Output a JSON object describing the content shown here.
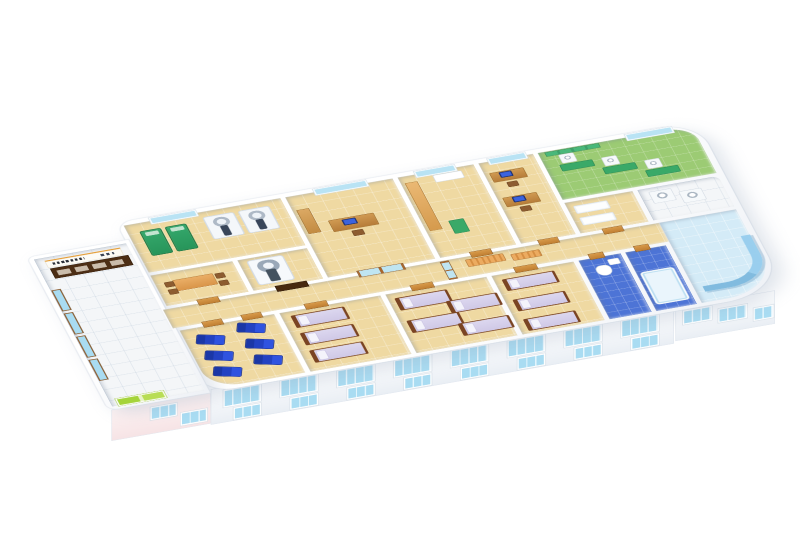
{
  "figure": {
    "type": "3d-isometric-floor-plan",
    "subject": "clinic-ward-floor",
    "background": "#ffffff"
  },
  "palette": {
    "wall": "#ffffff",
    "floor_tile": "#efd9a2",
    "lobby_tile": "#f4f6f8",
    "bath_blue": "#4d74d6",
    "physio_green": "#9ccb74",
    "lounge_blue": "#d4ebf7",
    "window_blue": "#a9dcf2",
    "door_wood": "#c98636",
    "bed_linen": "#d5d0e9",
    "bed_frame": "#7a4423",
    "recliner_blue": "#2342c2",
    "exam_green": "#2f9e62",
    "reception_brown": "#4c2e15",
    "sign_accent": "#e59f3a",
    "entrance_green": "#a5d43a"
  },
  "scene": {
    "plan": {
      "w": 1080,
      "h": 520
    },
    "slabs": [
      {
        "id": "main-wing",
        "x": 160,
        "y": 8,
        "w": 918,
        "h": 470,
        "br": "26px 64px 96px 44px"
      },
      {
        "id": "lobby-wing",
        "x": 4,
        "y": 56,
        "w": 160,
        "h": 422,
        "br": "12px 0px 0px 16px"
      }
    ],
    "rooms": [
      {
        "id": "lobby",
        "x": 12,
        "y": 64,
        "w": 146,
        "h": 406,
        "floor": "white",
        "br": "0"
      },
      {
        "id": "radiology",
        "x": 168,
        "y": 18,
        "w": 248,
        "h": 130,
        "floor": "beige",
        "br": "0"
      },
      {
        "id": "meeting",
        "x": 168,
        "y": 156,
        "w": 130,
        "h": 84,
        "floor": "beige",
        "br": "0"
      },
      {
        "id": "ct",
        "x": 306,
        "y": 156,
        "w": 110,
        "h": 84,
        "floor": "beige",
        "br": "0"
      },
      {
        "id": "consult-office",
        "x": 424,
        "y": 18,
        "w": 170,
        "h": 222,
        "floor": "beige",
        "br": "0"
      },
      {
        "id": "prep",
        "x": 602,
        "y": 18,
        "w": 120,
        "h": 222,
        "floor": "beige",
        "br": "0"
      },
      {
        "id": "doctor-office",
        "x": 730,
        "y": 18,
        "w": 86,
        "h": 222,
        "floor": "beige",
        "br": "0"
      },
      {
        "id": "physio",
        "x": 824,
        "y": 18,
        "w": 244,
        "h": 130,
        "floor": "green",
        "br": "0 40px 0 0"
      },
      {
        "id": "exam",
        "x": 824,
        "y": 156,
        "w": 108,
        "h": 84,
        "floor": "beige",
        "br": "0"
      },
      {
        "id": "utility",
        "x": 940,
        "y": 156,
        "w": 128,
        "h": 84,
        "floor": "white",
        "br": "0 12px 0 0"
      },
      {
        "id": "corridor",
        "x": 160,
        "y": 248,
        "w": 786,
        "h": 52,
        "floor": "beige",
        "br": "0"
      },
      {
        "id": "recliner-room",
        "x": 168,
        "y": 308,
        "w": 150,
        "h": 162,
        "floor": "beige",
        "br": "0 0 0 52px"
      },
      {
        "id": "ward-1",
        "x": 326,
        "y": 308,
        "w": 160,
        "h": 162,
        "floor": "beige",
        "br": "0"
      },
      {
        "id": "ward-2",
        "x": 494,
        "y": 308,
        "w": 160,
        "h": 162,
        "floor": "beige",
        "br": "0"
      },
      {
        "id": "ward-3",
        "x": 662,
        "y": 308,
        "w": 130,
        "h": 162,
        "floor": "beige",
        "br": "0"
      },
      {
        "id": "bathroom-1",
        "x": 800,
        "y": 308,
        "w": 66,
        "h": 162,
        "floor": "blue",
        "br": "0"
      },
      {
        "id": "bathroom-2",
        "x": 874,
        "y": 308,
        "w": 64,
        "h": 162,
        "floor": "blue",
        "br": "0"
      },
      {
        "id": "lounge",
        "x": 946,
        "y": 248,
        "w": 122,
        "h": 222,
        "floor": "lounge",
        "br": "0 0 84px 0"
      }
    ],
    "items": [
      {
        "t": "sign",
        "x": 26,
        "y": 72,
        "w": 118,
        "h": 16
      },
      {
        "t": "reception",
        "x": 28,
        "y": 94,
        "w": 122,
        "h": 26
      },
      {
        "t": "windowb",
        "x": 13,
        "y": 150,
        "w": 11,
        "h": 54
      },
      {
        "t": "windowb",
        "x": 13,
        "y": 214,
        "w": 11,
        "h": 54
      },
      {
        "t": "windowb",
        "x": 13,
        "y": 278,
        "w": 11,
        "h": 54
      },
      {
        "t": "windowb",
        "x": 13,
        "y": 342,
        "w": 11,
        "h": 54
      },
      {
        "t": "greendoor",
        "x": 22,
        "y": 452,
        "w": 72,
        "h": 16
      },
      {
        "t": "window",
        "x": 210,
        "y": 10,
        "w": 70,
        "h": 13
      },
      {
        "t": "greenbed",
        "x": 186,
        "y": 40,
        "w": 30,
        "h": 64
      },
      {
        "t": "greenbed",
        "x": 226,
        "y": 40,
        "w": 30,
        "h": 64
      },
      {
        "t": "scanner",
        "x": 288,
        "y": 32,
        "w": 46,
        "h": 58
      },
      {
        "t": "scanner",
        "x": 344,
        "y": 32,
        "w": 46,
        "h": 58
      },
      {
        "t": "table",
        "x": 196,
        "y": 178,
        "w": 62,
        "h": 28
      },
      {
        "t": "chair",
        "x": 182,
        "y": 180,
        "w": 13,
        "h": 12
      },
      {
        "t": "chair",
        "x": 182,
        "y": 200,
        "w": 13,
        "h": 12
      },
      {
        "t": "chair",
        "x": 262,
        "y": 180,
        "w": 13,
        "h": 12
      },
      {
        "t": "chair",
        "x": 262,
        "y": 200,
        "w": 13,
        "h": 12
      },
      {
        "t": "ct",
        "x": 318,
        "y": 162,
        "w": 54,
        "h": 64
      },
      {
        "t": "doordark",
        "x": 340,
        "y": 238,
        "w": 48,
        "h": 14
      },
      {
        "t": "door",
        "x": 216,
        "y": 238,
        "w": 32,
        "h": 14
      },
      {
        "t": "window",
        "x": 470,
        "y": 10,
        "w": 80,
        "h": 13
      },
      {
        "t": "cab",
        "x": 430,
        "y": 56,
        "w": 18,
        "h": 64
      },
      {
        "t": "desk",
        "x": 468,
        "y": 96,
        "w": 70,
        "h": 30
      },
      {
        "t": "monitor",
        "x": 488,
        "y": 100,
        "w": 18,
        "h": 12
      },
      {
        "t": "chair",
        "x": 494,
        "y": 132,
        "w": 16,
        "h": 13
      },
      {
        "t": "glassdoor",
        "x": 470,
        "y": 236,
        "w": 72,
        "h": 16
      },
      {
        "t": "window",
        "x": 630,
        "y": 10,
        "w": 60,
        "h": 13
      },
      {
        "t": "counter",
        "x": 608,
        "y": 36,
        "w": 18,
        "h": 130
      },
      {
        "t": "sink",
        "x": 654,
        "y": 28,
        "w": 44,
        "h": 18
      },
      {
        "t": "mat",
        "x": 642,
        "y": 150,
        "w": 22,
        "h": 34
      },
      {
        "t": "door",
        "x": 648,
        "y": 238,
        "w": 32,
        "h": 14
      },
      {
        "t": "window",
        "x": 746,
        "y": 10,
        "w": 56,
        "h": 13
      },
      {
        "t": "desk",
        "x": 738,
        "y": 48,
        "w": 52,
        "h": 24
      },
      {
        "t": "monitor",
        "x": 752,
        "y": 50,
        "w": 16,
        "h": 11
      },
      {
        "t": "chair",
        "x": 756,
        "y": 78,
        "w": 15,
        "h": 12
      },
      {
        "t": "desk",
        "x": 738,
        "y": 116,
        "w": 52,
        "h": 24
      },
      {
        "t": "monitor",
        "x": 752,
        "y": 118,
        "w": 16,
        "h": 11
      },
      {
        "t": "chair",
        "x": 756,
        "y": 146,
        "w": 15,
        "h": 12
      },
      {
        "t": "door",
        "x": 756,
        "y": 238,
        "w": 30,
        "h": 14
      },
      {
        "t": "greenwall",
        "x": 834,
        "y": 20,
        "w": 84,
        "h": 10
      },
      {
        "t": "window",
        "x": 964,
        "y": 10,
        "w": 70,
        "h": 13
      },
      {
        "t": "machine",
        "x": 852,
        "y": 32,
        "w": 22,
        "h": 22
      },
      {
        "t": "mat",
        "x": 846,
        "y": 58,
        "w": 50,
        "h": 16
      },
      {
        "t": "machine",
        "x": 912,
        "y": 58,
        "w": 22,
        "h": 22
      },
      {
        "t": "mat",
        "x": 906,
        "y": 84,
        "w": 50,
        "h": 16
      },
      {
        "t": "machine",
        "x": 972,
        "y": 84,
        "w": 22,
        "h": 22
      },
      {
        "t": "mat",
        "x": 966,
        "y": 110,
        "w": 50,
        "h": 16
      },
      {
        "t": "extable",
        "x": 834,
        "y": 168,
        "w": 52,
        "h": 20
      },
      {
        "t": "extable",
        "x": 834,
        "y": 200,
        "w": 52,
        "h": 20
      },
      {
        "t": "door",
        "x": 858,
        "y": 238,
        "w": 30,
        "h": 14
      },
      {
        "t": "machine",
        "x": 954,
        "y": 166,
        "w": 34,
        "h": 30
      },
      {
        "t": "machine",
        "x": 998,
        "y": 178,
        "w": 34,
        "h": 30
      },
      {
        "t": "bench",
        "x": 636,
        "y": 256,
        "w": 58,
        "h": 18
      },
      {
        "t": "bench",
        "x": 706,
        "y": 262,
        "w": 44,
        "h": 16
      },
      {
        "t": "glassdoorv",
        "x": 598,
        "y": 250,
        "w": 12,
        "h": 48
      },
      {
        "t": "door",
        "x": 206,
        "y": 296,
        "w": 30,
        "h": 14
      },
      {
        "t": "door",
        "x": 268,
        "y": 296,
        "w": 30,
        "h": 14
      },
      {
        "t": "door",
        "x": 368,
        "y": 296,
        "w": 34,
        "h": 14
      },
      {
        "t": "door",
        "x": 536,
        "y": 296,
        "w": 34,
        "h": 14
      },
      {
        "t": "door",
        "x": 700,
        "y": 296,
        "w": 34,
        "h": 14
      },
      {
        "t": "door",
        "x": 818,
        "y": 296,
        "w": 22,
        "h": 14
      },
      {
        "t": "door",
        "x": 890,
        "y": 296,
        "w": 22,
        "h": 14
      },
      {
        "t": "recliner",
        "x": 184,
        "y": 332,
        "w": 42,
        "h": 24,
        "r": 20
      },
      {
        "t": "recliner",
        "x": 184,
        "y": 376,
        "w": 42,
        "h": 24,
        "r": 20
      },
      {
        "t": "recliner",
        "x": 184,
        "y": 420,
        "w": 42,
        "h": 24,
        "r": 20
      },
      {
        "t": "recliner",
        "x": 252,
        "y": 320,
        "w": 42,
        "h": 24,
        "r": 20
      },
      {
        "t": "recliner",
        "x": 252,
        "y": 364,
        "w": 42,
        "h": 24,
        "r": 20
      },
      {
        "t": "recliner",
        "x": 252,
        "y": 408,
        "w": 42,
        "h": 24,
        "r": 20
      },
      {
        "t": "bed",
        "x": 340,
        "y": 320,
        "w": 74,
        "h": 30
      },
      {
        "t": "bed",
        "x": 340,
        "y": 368,
        "w": 74,
        "h": 30
      },
      {
        "t": "bed",
        "x": 340,
        "y": 416,
        "w": 74,
        "h": 30
      },
      {
        "t": "bed",
        "x": 504,
        "y": 322,
        "w": 72,
        "h": 30
      },
      {
        "t": "bed",
        "x": 504,
        "y": 384,
        "w": 72,
        "h": 30
      },
      {
        "t": "bed",
        "x": 576,
        "y": 352,
        "w": 70,
        "h": 30
      },
      {
        "t": "bed",
        "x": 576,
        "y": 414,
        "w": 70,
        "h": 30
      },
      {
        "t": "bed",
        "x": 674,
        "y": 322,
        "w": 72,
        "h": 28
      },
      {
        "t": "bed",
        "x": 674,
        "y": 378,
        "w": 72,
        "h": 28
      },
      {
        "t": "bed",
        "x": 674,
        "y": 432,
        "w": 72,
        "h": 28
      },
      {
        "t": "toilet",
        "x": 818,
        "y": 330,
        "w": 22,
        "h": 26
      },
      {
        "t": "sink",
        "x": 842,
        "y": 318,
        "w": 16,
        "h": 14
      },
      {
        "t": "tub",
        "x": 880,
        "y": 366,
        "w": 48,
        "h": 84
      },
      {
        "t": "sofa",
        "x": 960,
        "y": 318,
        "w": 94,
        "h": 110
      }
    ],
    "facades": [
      {
        "id": "front-main",
        "x": 168,
        "y": 470,
        "w": 734,
        "h": 66,
        "tint": "white",
        "windows": [
          [
            20,
            6,
            56,
            28
          ],
          [
            110,
            6,
            56,
            28
          ],
          [
            200,
            6,
            56,
            28
          ],
          [
            290,
            6,
            56,
            28
          ],
          [
            380,
            6,
            56,
            28
          ],
          [
            470,
            6,
            56,
            28
          ],
          [
            560,
            6,
            56,
            28
          ],
          [
            650,
            6,
            56,
            28
          ],
          [
            36,
            42,
            40,
            18
          ],
          [
            126,
            42,
            40,
            18
          ],
          [
            216,
            42,
            40,
            18
          ],
          [
            306,
            42,
            40,
            18
          ],
          [
            396,
            42,
            40,
            18
          ],
          [
            486,
            42,
            40,
            18
          ],
          [
            576,
            42,
            40,
            18
          ],
          [
            666,
            42,
            40,
            18
          ]
        ]
      },
      {
        "id": "front-lobby",
        "x": 8,
        "y": 478,
        "w": 158,
        "h": 58,
        "tint": "pink",
        "windows": [
          [
            62,
            8,
            38,
            20
          ],
          [
            110,
            28,
            38,
            20
          ]
        ]
      },
      {
        "id": "front-right",
        "x": 904,
        "y": 470,
        "w": 158,
        "h": 62,
        "tint": "white",
        "windows": [
          [
            12,
            8,
            42,
            22
          ],
          [
            68,
            16,
            42,
            22
          ],
          [
            124,
            26,
            28,
            20
          ]
        ]
      }
    ]
  }
}
